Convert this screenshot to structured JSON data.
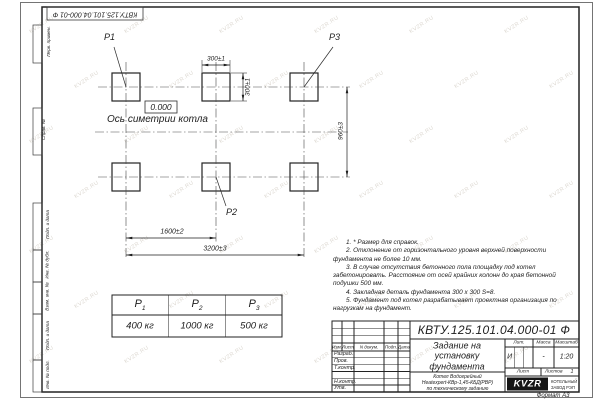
{
  "sheet": {
    "stamp_top": "КВТУ.125.101.04.000-01 Ф",
    "format_label": "Формат А3"
  },
  "margin_labels": [
    "Перв. примен.",
    "Справ. №",
    "Подп. и дата",
    "Инв. № дубл.",
    "Взам. инв. №",
    "Подп. и дата",
    "Инв. № подл."
  ],
  "drawing": {
    "point_labels": {
      "p1": "P1",
      "p2": "P2",
      "p3": "P3"
    },
    "elevation": "0.000",
    "axis_label": "Ось симетрии котла",
    "dimensions": {
      "pad_width": "300±1",
      "pad_height": "300±1",
      "row_spacing": "960±3",
      "col_spacing": "1600±2",
      "total_span": "3200±3"
    }
  },
  "notes": [
    "1. * Размер для справок.",
    "2. Отклонение от горизонтального уровня верхней поверхности фундамента не более 10 мм.",
    "3. В случае отсутствия бетонного пола площадку под котел забетонировать. Расстояние от осей крайних колонн до края бетонной подушки 500 мм.",
    "4. Закладная деталь фундамента 300 x 300 S=8.",
    "5. Фундамент под котел разрабатывает проектная организация по нагрузкам на фундамент."
  ],
  "load_table": {
    "headers": [
      {
        "base": "P",
        "sub": "1"
      },
      {
        "base": "P",
        "sub": "2"
      },
      {
        "base": "P",
        "sub": "3"
      }
    ],
    "values": [
      "400 кг",
      "1000 кг",
      "500 кг"
    ]
  },
  "title_block": {
    "doc_number": "КВТУ.125.101.04.000-01 Ф",
    "title": "Задание на установку фундамента",
    "product_lines": [
      "Котел Водогрейный",
      "Heatexpert-КВр-1,45-КБД(РВР)",
      "по техническому заданию"
    ],
    "cols": {
      "izm": "Изм.",
      "list": "Лист",
      "doc": "N докум.",
      "sign": "Подп.",
      "date": "Дата"
    },
    "rows": [
      "Разраб.",
      "Пров.",
      "Т.контр.",
      "",
      "Н.контр.",
      "Утв."
    ],
    "lit": {
      "label": "Лит.",
      "value": "И"
    },
    "mass": {
      "label": "Масса",
      "value": "-"
    },
    "scale": {
      "label": "Масштаб",
      "value": "1:20"
    },
    "sheet": {
      "label": "Лист",
      "of_label": "Листов",
      "of_value": "1"
    },
    "logo": {
      "text": "KVZR",
      "company": [
        "КОТЕЛЬНЫЙ",
        "ЗАВОД РЭП"
      ]
    }
  },
  "watermark": {
    "text": "KVZR.RU"
  }
}
